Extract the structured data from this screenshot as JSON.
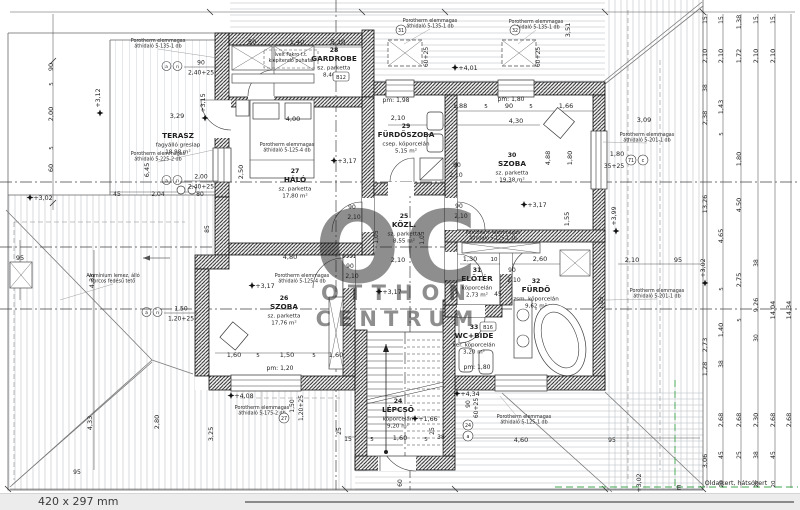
{
  "footer": {
    "format": "420 x 297 mm"
  },
  "watermark": {
    "logo": "OC",
    "line1": "OTTHON",
    "line2": "CENTRUM"
  },
  "site": {
    "boundary_label": "Oldalkert, hátsókert",
    "marker": "E",
    "color": "#3fa54b"
  },
  "rooms": [
    {
      "num": "",
      "name": "TERASZ",
      "finish": "fagyálló greslap",
      "area": "18,98 m²",
      "x": 178,
      "y": 138
    },
    {
      "num": "28",
      "name": "GARDROBE",
      "finish": "sz. parketta",
      "area": "8,46 m²",
      "x": 334,
      "y": 52
    },
    {
      "num": "27",
      "name": "HÁLÓ",
      "finish": "sz. parketta",
      "area": "17,80 m²",
      "x": 295,
      "y": 173
    },
    {
      "num": "29",
      "name": "FÜRDŐSZOBA",
      "finish": "csep. köporcelán",
      "area": "5,15 m²",
      "x": 406,
      "y": 128
    },
    {
      "num": "30",
      "name": "SZOBA",
      "finish": "sz. parketta",
      "area": "19,38 m²",
      "x": 512,
      "y": 157
    },
    {
      "num": "25",
      "name": "KÖZL.",
      "finish": "sz. parketta",
      "area": "8,55 m²",
      "x": 404,
      "y": 218
    },
    {
      "num": "26",
      "name": "SZOBA",
      "finish": "sz. parketta",
      "area": "17,76 m²",
      "x": 284,
      "y": 300
    },
    {
      "num": "31",
      "name": "ELŐTÉR",
      "finish": "köporcelán",
      "area": "2,73 m²",
      "x": 477,
      "y": 272
    },
    {
      "num": "32",
      "name": "FÜRDŐ",
      "finish": "zsm. köporcelán",
      "area": "9,62 m²",
      "x": 536,
      "y": 283
    },
    {
      "num": "33",
      "name": "WC+BIDE",
      "finish": "ker. köporcelán",
      "area": "3,20 m²",
      "x": 474,
      "y": 329
    },
    {
      "num": "24",
      "name": "LÉPCSŐ",
      "finish": "köporcelán",
      "area": "9,20 m²",
      "x": 398,
      "y": 403
    }
  ],
  "levels": [
    {
      "t": "+3,02",
      "x": 43,
      "y": 200
    },
    {
      "t": "+3,12",
      "x": 100,
      "y": 98,
      "r": 1
    },
    {
      "t": "+3,15",
      "x": 205,
      "y": 103,
      "r": 1
    },
    {
      "t": "+3,17",
      "x": 347,
      "y": 163
    },
    {
      "t": "+3,17",
      "x": 537,
      "y": 207
    },
    {
      "t": "+3,17",
      "x": 265,
      "y": 288
    },
    {
      "t": "+3,17",
      "x": 392,
      "y": 294
    },
    {
      "t": "+3,99",
      "x": 616,
      "y": 216,
      "r": 1
    },
    {
      "t": "+4,01",
      "x": 468,
      "y": 70
    },
    {
      "t": "+4,34",
      "x": 470,
      "y": 396
    },
    {
      "t": "+4,08",
      "x": 244,
      "y": 398
    },
    {
      "t": "+1,66",
      "x": 428,
      "y": 421
    },
    {
      "t": "+3,02",
      "x": 705,
      "y": 268,
      "r": 1
    },
    {
      "t": "+3,02",
      "x": 641,
      "y": 483,
      "r": 1
    },
    {
      "t": "+3,02",
      "x": 254,
      "y": 501
    }
  ],
  "dims": [
    {
      "t": "50",
      "x": 252,
      "y": 44
    },
    {
      "t": "1,40",
      "x": 297,
      "y": 44
    },
    {
      "t": "5,10",
      "x": 338,
      "y": 44
    },
    {
      "t": "60+25",
      "x": 428,
      "y": 57,
      "r": 1,
      "s": 6
    },
    {
      "t": "60+25",
      "x": 540,
      "y": 57,
      "r": 1,
      "s": 6
    },
    {
      "t": "3,51",
      "x": 570,
      "y": 30,
      "r": 1
    },
    {
      "t": "3,09",
      "x": 644,
      "y": 122
    },
    {
      "t": "1,80",
      "x": 617,
      "y": 156
    },
    {
      "t": "35+25",
      "x": 614,
      "y": 168,
      "s": 6
    },
    {
      "t": "pm: 1,98",
      "x": 396,
      "y": 102,
      "s": 6
    },
    {
      "t": "pm: 1,80",
      "x": 511,
      "y": 101,
      "s": 6
    },
    {
      "t": "1,88",
      "x": 460,
      "y": 108
    },
    {
      "t": "5",
      "x": 486,
      "y": 108,
      "s": 5.5
    },
    {
      "t": "90",
      "x": 509,
      "y": 108
    },
    {
      "t": "5",
      "x": 531,
      "y": 108,
      "s": 5.5
    },
    {
      "t": "1,66",
      "x": 566,
      "y": 108
    },
    {
      "t": "2,10",
      "x": 398,
      "y": 120
    },
    {
      "t": "4,30",
      "x": 516,
      "y": 123
    },
    {
      "t": "90",
      "x": 457,
      "y": 167,
      "s": 6
    },
    {
      "t": "2,10",
      "x": 456,
      "y": 177,
      "s": 6
    },
    {
      "t": "4,00",
      "x": 293,
      "y": 121
    },
    {
      "t": "2,50",
      "x": 243,
      "y": 172,
      "r": 1
    },
    {
      "t": "85",
      "x": 209,
      "y": 229,
      "r": 1,
      "s": 6
    },
    {
      "t": "3,29",
      "x": 177,
      "y": 118
    },
    {
      "t": "6,45",
      "x": 149,
      "y": 170,
      "r": 1
    },
    {
      "t": "45",
      "x": 117,
      "y": 196,
      "s": 6
    },
    {
      "t": "2,04",
      "x": 158,
      "y": 196,
      "s": 6
    },
    {
      "t": "80",
      "x": 200,
      "y": 196,
      "s": 6
    },
    {
      "t": "90",
      "x": 53,
      "y": 67,
      "r": 1
    },
    {
      "t": "5",
      "x": 53,
      "y": 84,
      "r": 1,
      "s": 5.5
    },
    {
      "t": "2,00",
      "x": 53,
      "y": 114,
      "r": 1
    },
    {
      "t": "5",
      "x": 53,
      "y": 148,
      "r": 1,
      "s": 5.5
    },
    {
      "t": "60",
      "x": 53,
      "y": 168,
      "r": 1
    },
    {
      "t": "95",
      "x": 20,
      "y": 260
    },
    {
      "t": "4,33",
      "x": 94,
      "y": 281,
      "r": 1
    },
    {
      "t": "4,33",
      "x": 92,
      "y": 423,
      "r": 1
    },
    {
      "t": "2,80",
      "x": 159,
      "y": 422,
      "r": 1
    },
    {
      "t": "3,25",
      "x": 213,
      "y": 434,
      "r": 1
    },
    {
      "t": "95",
      "x": 77,
      "y": 474,
      "s": 6
    },
    {
      "t": "2,10",
      "x": 398,
      "y": 262
    },
    {
      "t": "1,05",
      "x": 378,
      "y": 237,
      "r": 1,
      "s": 6
    },
    {
      "t": "1,05",
      "x": 424,
      "y": 238,
      "r": 1,
      "s": 6
    },
    {
      "t": "90",
      "x": 352,
      "y": 209,
      "s": 6
    },
    {
      "t": "2,10",
      "x": 354,
      "y": 219,
      "s": 6
    },
    {
      "t": "90",
      "x": 459,
      "y": 208,
      "s": 6
    },
    {
      "t": "2,10",
      "x": 461,
      "y": 218,
      "s": 6
    },
    {
      "t": "90",
      "x": 350,
      "y": 268,
      "s": 6
    },
    {
      "t": "2,10",
      "x": 352,
      "y": 278,
      "s": 6
    },
    {
      "t": "90",
      "x": 512,
      "y": 272,
      "s": 6
    },
    {
      "t": "2,10",
      "x": 514,
      "y": 282,
      "s": 6
    },
    {
      "t": "4,80",
      "x": 290,
      "y": 259
    },
    {
      "t": "1,30",
      "x": 470,
      "y": 261
    },
    {
      "t": "10",
      "x": 494,
      "y": 261,
      "s": 5.5
    },
    {
      "t": "2,60",
      "x": 540,
      "y": 261
    },
    {
      "t": "45",
      "x": 498,
      "y": 296,
      "s": 6
    },
    {
      "t": "4,88",
      "x": 550,
      "y": 158,
      "r": 1
    },
    {
      "t": "1,80",
      "x": 572,
      "y": 158,
      "r": 1
    },
    {
      "t": "1,55",
      "x": 569,
      "y": 219,
      "r": 1
    },
    {
      "t": "1,05",
      "x": 603,
      "y": 303,
      "r": 1,
      "s": 6
    },
    {
      "t": "2,10",
      "x": 632,
      "y": 262
    },
    {
      "t": "95",
      "x": 678,
      "y": 262
    },
    {
      "t": "1,60",
      "x": 234,
      "y": 357
    },
    {
      "t": "5",
      "x": 258,
      "y": 357,
      "s": 5.5
    },
    {
      "t": "1,50",
      "x": 287,
      "y": 357
    },
    {
      "t": "5",
      "x": 314,
      "y": 357,
      "s": 5.5
    },
    {
      "t": "1,60",
      "x": 336,
      "y": 357
    },
    {
      "t": "pm: 1,20",
      "x": 280,
      "y": 370,
      "s": 6
    },
    {
      "t": "1,50",
      "x": 294,
      "y": 406,
      "r": 1,
      "s": 6
    },
    {
      "t": "1,20+25",
      "x": 303,
      "y": 408,
      "r": 1,
      "s": 6
    },
    {
      "t": "pm: 1,80",
      "x": 477,
      "y": 369,
      "s": 6
    },
    {
      "t": "4,60",
      "x": 521,
      "y": 442
    },
    {
      "t": "95",
      "x": 612,
      "y": 442,
      "s": 6
    },
    {
      "t": "15",
      "x": 348,
      "y": 441,
      "s": 6
    },
    {
      "t": "5",
      "x": 372,
      "y": 441,
      "s": 5.5
    },
    {
      "t": "1,60",
      "x": 400,
      "y": 440
    },
    {
      "t": "5",
      "x": 426,
      "y": 441,
      "s": 5.5
    },
    {
      "t": "38",
      "x": 441,
      "y": 439,
      "s": 6
    },
    {
      "t": "25",
      "x": 341,
      "y": 431,
      "r": 1,
      "s": 6
    },
    {
      "t": "25",
      "x": 434,
      "y": 431,
      "r": 1,
      "s": 6
    },
    {
      "t": "60",
      "x": 402,
      "y": 483,
      "r": 1,
      "s": 6
    },
    {
      "t": "90",
      "x": 470,
      "y": 404,
      "r": 1,
      "s": 6
    },
    {
      "t": "60+25",
      "x": 478,
      "y": 408,
      "r": 1,
      "s": 6
    },
    {
      "t": "15",
      "x": 707,
      "y": 20,
      "r": 1,
      "s": 6
    },
    {
      "t": "2,10",
      "x": 707,
      "y": 56,
      "r": 1
    },
    {
      "t": "38",
      "x": 707,
      "y": 88,
      "r": 1,
      "s": 6
    },
    {
      "t": "2,38",
      "x": 707,
      "y": 118,
      "r": 1
    },
    {
      "t": "13,26",
      "x": 707,
      "y": 204,
      "r": 1
    },
    {
      "t": "2,73",
      "x": 707,
      "y": 345,
      "r": 1
    },
    {
      "t": "1,28",
      "x": 707,
      "y": 369,
      "r": 1
    },
    {
      "t": "3,06",
      "x": 707,
      "y": 461,
      "r": 1
    },
    {
      "t": "15",
      "x": 723,
      "y": 20,
      "r": 1,
      "s": 6
    },
    {
      "t": "2,10",
      "x": 723,
      "y": 56,
      "r": 1
    },
    {
      "t": "1,43",
      "x": 723,
      "y": 107,
      "r": 1
    },
    {
      "t": "5",
      "x": 723,
      "y": 134,
      "r": 1,
      "s": 5.5
    },
    {
      "t": "4,65",
      "x": 723,
      "y": 236,
      "r": 1
    },
    {
      "t": "5",
      "x": 723,
      "y": 289,
      "r": 1,
      "s": 5.5
    },
    {
      "t": "1,40",
      "x": 723,
      "y": 330,
      "r": 1
    },
    {
      "t": "38",
      "x": 723,
      "y": 364,
      "r": 1,
      "s": 6
    },
    {
      "t": "2,68",
      "x": 723,
      "y": 420,
      "r": 1
    },
    {
      "t": "45",
      "x": 723,
      "y": 455,
      "r": 1,
      "s": 6
    },
    {
      "t": "20",
      "x": 723,
      "y": 484,
      "r": 1,
      "s": 5.5
    },
    {
      "t": "1,38",
      "x": 741,
      "y": 22,
      "r": 1
    },
    {
      "t": "1,72",
      "x": 741,
      "y": 56,
      "r": 1
    },
    {
      "t": "1,80",
      "x": 741,
      "y": 159,
      "r": 1
    },
    {
      "t": "4,50",
      "x": 741,
      "y": 205,
      "r": 1
    },
    {
      "t": "2,75",
      "x": 741,
      "y": 280,
      "r": 1
    },
    {
      "t": "5",
      "x": 741,
      "y": 320,
      "r": 1,
      "s": 5.5
    },
    {
      "t": "2,68",
      "x": 741,
      "y": 420,
      "r": 1
    },
    {
      "t": "25",
      "x": 741,
      "y": 455,
      "r": 1,
      "s": 6
    },
    {
      "t": "15",
      "x": 758,
      "y": 20,
      "r": 1,
      "s": 6
    },
    {
      "t": "2,10",
      "x": 758,
      "y": 56,
      "r": 1
    },
    {
      "t": "38",
      "x": 758,
      "y": 263,
      "r": 1,
      "s": 6
    },
    {
      "t": "9,26",
      "x": 758,
      "y": 305,
      "r": 1
    },
    {
      "t": "30",
      "x": 758,
      "y": 338,
      "r": 1,
      "s": 6
    },
    {
      "t": "2,30",
      "x": 758,
      "y": 420,
      "r": 1
    },
    {
      "t": "38",
      "x": 758,
      "y": 455,
      "r": 1,
      "s": 6
    },
    {
      "t": "25",
      "x": 758,
      "y": 484,
      "r": 1,
      "s": 5.5
    },
    {
      "t": "15",
      "x": 775,
      "y": 20,
      "r": 1,
      "s": 6
    },
    {
      "t": "2,10",
      "x": 775,
      "y": 56,
      "r": 1
    },
    {
      "t": "14,04",
      "x": 775,
      "y": 310,
      "r": 1
    },
    {
      "t": "2,68",
      "x": 775,
      "y": 420,
      "r": 1
    },
    {
      "t": "45",
      "x": 775,
      "y": 455,
      "r": 1,
      "s": 6
    },
    {
      "t": "20",
      "x": 775,
      "y": 484,
      "r": 1,
      "s": 5.5
    },
    {
      "t": "14,34",
      "x": 791,
      "y": 310,
      "r": 1
    },
    {
      "t": "2,68",
      "x": 791,
      "y": 420,
      "r": 1
    }
  ],
  "annotations": [
    {
      "l1": "Porotherm elemmagas",
      "l2": "áthidaló 5-135-1 db",
      "x": 158,
      "y": 42,
      "lx": 218,
      "ly": 58
    },
    {
      "l1": "Porotherm elemmagas",
      "l2": "áthidaló 5-225-2 db",
      "x": 158,
      "y": 155,
      "lx": 213,
      "ly": 150
    },
    {
      "l1": "Porotherm elemmagas",
      "l2": "áthidaló 5-135-1 db",
      "x": 430,
      "y": 22,
      "lx": 404,
      "ly": 44
    },
    {
      "l1": "Porotherm elemmagas",
      "l2": "áthidaló 5-135-1 db",
      "x": 536,
      "y": 23,
      "lx": 518,
      "ly": 44
    },
    {
      "l1": "Porotherm elemmagas",
      "l2": "áthidaló 5-125-4 db",
      "x": 287,
      "y": 146
    },
    {
      "l1": "Porotherm elemmagas",
      "l2": "áthidaló 5-125-4 db",
      "x": 302,
      "y": 277
    },
    {
      "l1": "Porotherm elemmagas",
      "l2": "áthidaló 5-125-1 db",
      "x": 493,
      "y": 234
    },
    {
      "l1": "Porotherm elemmagas",
      "l2": "áthidaló 5-201-1 db",
      "x": 647,
      "y": 136,
      "lx": 603,
      "ly": 142
    },
    {
      "l1": "Porotherm elemmagas",
      "l2": "áthidaló 5-201-1 db",
      "x": 657,
      "y": 292,
      "lx": 606,
      "ly": 300
    },
    {
      "l1": "Alumínium lemez, álló",
      "l2": "korcos fedésű tető",
      "x": 113,
      "y": 277,
      "lx": 60,
      "ly": 300
    },
    {
      "l1": "Porotherm elemmagas",
      "l2": "áthidaló 5-125-1 db",
      "x": 524,
      "y": 418,
      "lx": 500,
      "ly": 396
    },
    {
      "l1": "Porotherm elemmagas",
      "l2": "áthidaló 5-175-2 db",
      "x": 262,
      "y": 409,
      "lx": 262,
      "ly": 392
    }
  ],
  "note_box": {
    "l1": "Ívelt Fakro t.t.",
    "l2": "kiépítendő puhafal",
    "x": 291,
    "y": 56
  },
  "tags": [
    {
      "x": 172,
      "y": 66,
      "c1": "a",
      "c2": "n",
      "top": "90",
      "bottom": "2,40+25",
      "side": "r"
    },
    {
      "x": 172,
      "y": 180,
      "c1": "a",
      "c2": "n",
      "top": "2,00",
      "bottom": "2,40+25",
      "side": "r"
    },
    {
      "x": 152,
      "y": 312,
      "c1": "a",
      "c2": "n",
      "top": "1,50",
      "bottom": "1,20+25",
      "side": "r"
    }
  ],
  "circle_tags": [
    {
      "t": "27",
      "x": 284,
      "y": 418
    },
    {
      "t": "31",
      "x": 401,
      "y": 30
    },
    {
      "t": "32",
      "x": 515,
      "y": 30
    },
    {
      "t": "24",
      "x": 468,
      "y": 425
    },
    {
      "t": "a",
      "x": 468,
      "y": 436
    },
    {
      "t": "71",
      "x": 631,
      "y": 160
    },
    {
      "t": "c",
      "x": 643,
      "y": 160
    }
  ],
  "box_tags": [
    {
      "t": "B12",
      "x": 341,
      "y": 77
    },
    {
      "t": "B16",
      "x": 488,
      "y": 327
    }
  ]
}
